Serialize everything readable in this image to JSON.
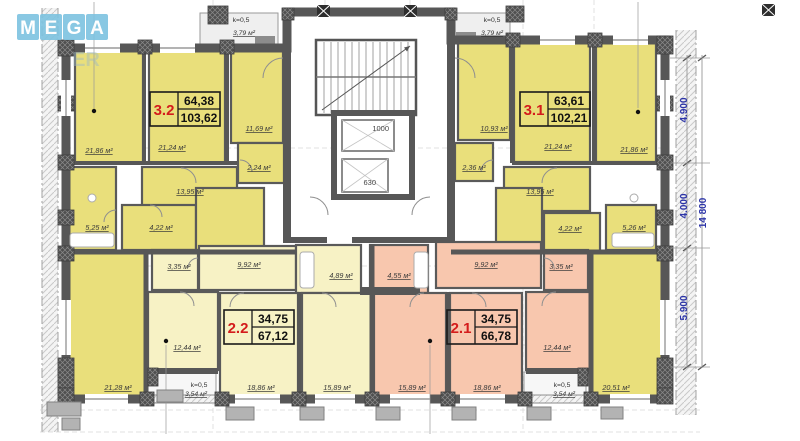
{
  "logo": {
    "l1": "M",
    "l2": "E",
    "l3": "G",
    "l4": "A",
    "faded": "ER"
  },
  "apartments": {
    "a32": {
      "number": "3.2",
      "living": "64,38",
      "total": "103,62"
    },
    "a31": {
      "number": "3.1",
      "living": "63,61",
      "total": "102,21"
    },
    "a22": {
      "number": "2.2",
      "living": "34,75",
      "total": "67,12"
    },
    "a21": {
      "number": "2.1",
      "living": "34,75",
      "total": "66,78"
    }
  },
  "rooms": {
    "l_living1": "21,86 м²",
    "l_living2": "21,24 м²",
    "l_hall": "11,69 м²",
    "l_storage": "2,24 м²",
    "l_hall2": "13,95 м²",
    "l_bath": "5,25 м²",
    "l_wc": "4,22 м²",
    "l_room_bottom": "21,28 м²",
    "r_hall": "10,93 м²",
    "r_living2": "21,24 м²",
    "r_living1": "21,86 м²",
    "r_storage": "2,36 м²",
    "r_hall2": "13,95 м²",
    "r_wc": "4,22 м²",
    "r_bath": "5,26 м²",
    "r_room_bottom": "20,51 м²",
    "a22_wc": "3,35 м²",
    "a22_hall": "9,92 м²",
    "a22_bath": "4,89 м²",
    "a22_kitchen": "12,44 м²",
    "a22_room1": "18,86 м²",
    "a22_room2": "15,89 м²",
    "a21_bath": "4,55 м²",
    "a21_hall": "9,92 м²",
    "a21_wc": "3,35 м²",
    "a21_room2": "15,89 м²",
    "a21_room1": "18,86 м²",
    "a21_kitchen": "12,44 м²"
  },
  "loggias": {
    "top_left_k": "k=0,5",
    "top_left_area": "3,79 м²",
    "top_right_k": "k=0,5",
    "top_right_area": "3,79 м²",
    "bottom_left_k": "k=0,5",
    "bottom_left_area": "3,54 м²",
    "bottom_right_k": "k=0,5",
    "bottom_right_area": "3,54 м²"
  },
  "elevators": {
    "large": "1000",
    "small": "630"
  },
  "dimensions": {
    "d1": "4.900",
    "d2": "4.000",
    "d3": "5.900",
    "total": "14 800"
  },
  "colors": {
    "bright_yellow": "#e9df7b",
    "pale_yellow": "#f7f2c5",
    "pink": "#f8c7ae",
    "wall": "#575757",
    "apt_number_red": "#d41c1c",
    "dimension_blue": "#2d35a8",
    "logo_blue": "#7dc3e0"
  }
}
